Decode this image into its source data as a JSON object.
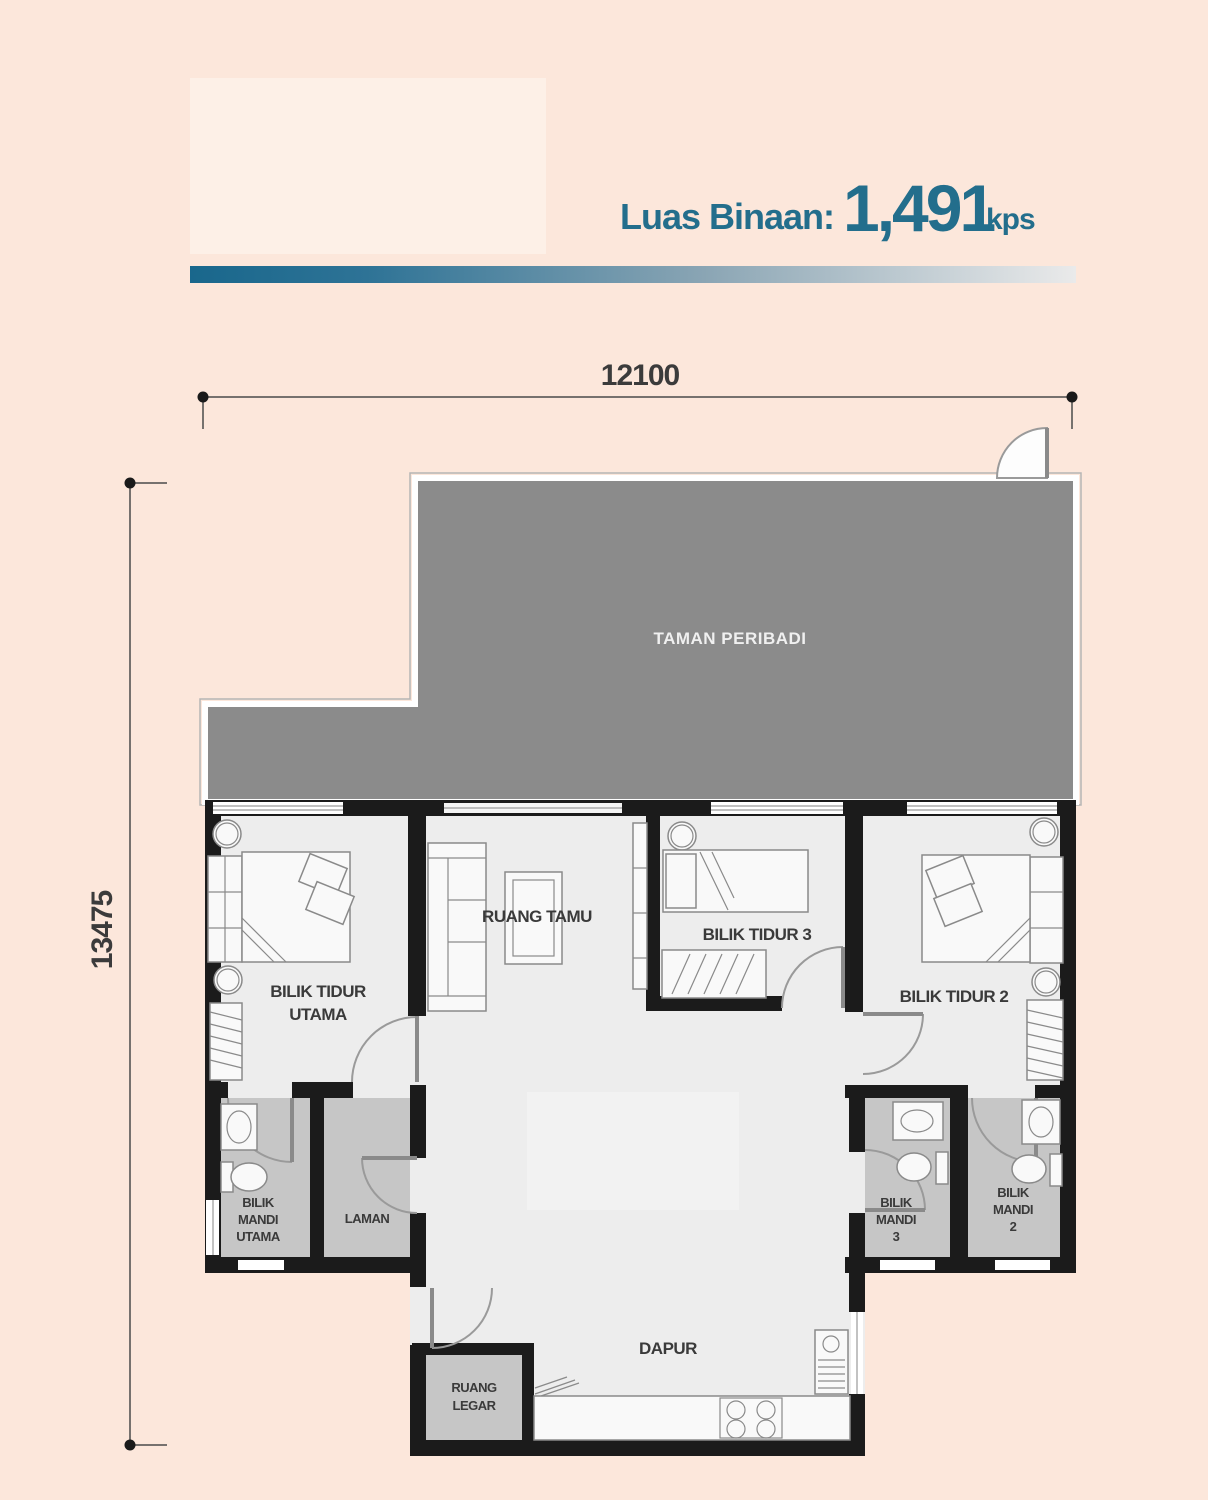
{
  "header": {
    "area_label": "Luas Binaan:",
    "area_value": "1,491",
    "area_unit": "kps"
  },
  "dimensions": {
    "width_mm": "12100",
    "height_mm": "13475"
  },
  "rooms": {
    "garden": "TAMAN PERIBADI",
    "living": "RUANG TAMU",
    "master_l1": "BILIK TIDUR",
    "master_l2": "UTAMA",
    "bed3": "BILIK TIDUR 3",
    "bed2": "BILIK TIDUR 2",
    "bath_master_l1": "BILIK",
    "bath_master_l2": "MANDI",
    "bath_master_l3": "UTAMA",
    "laman": "LAMAN",
    "bath3_l1": "BILIK",
    "bath3_l2": "MANDI",
    "bath3_l3": "3",
    "bath2_l1": "BILIK",
    "bath2_l2": "MANDI",
    "bath2_l3": "2",
    "kitchen": "DAPUR",
    "foyer_l1": "RUANG",
    "foyer_l2": "LEGAR"
  },
  "colors": {
    "background": "#fce7db",
    "accent_teal": "#236e8c",
    "garden_gray": "#8b8b8b",
    "wall_black": "#1b1b1b",
    "floor_light": "#ededed",
    "floor_wet": "#c6c6c6"
  }
}
